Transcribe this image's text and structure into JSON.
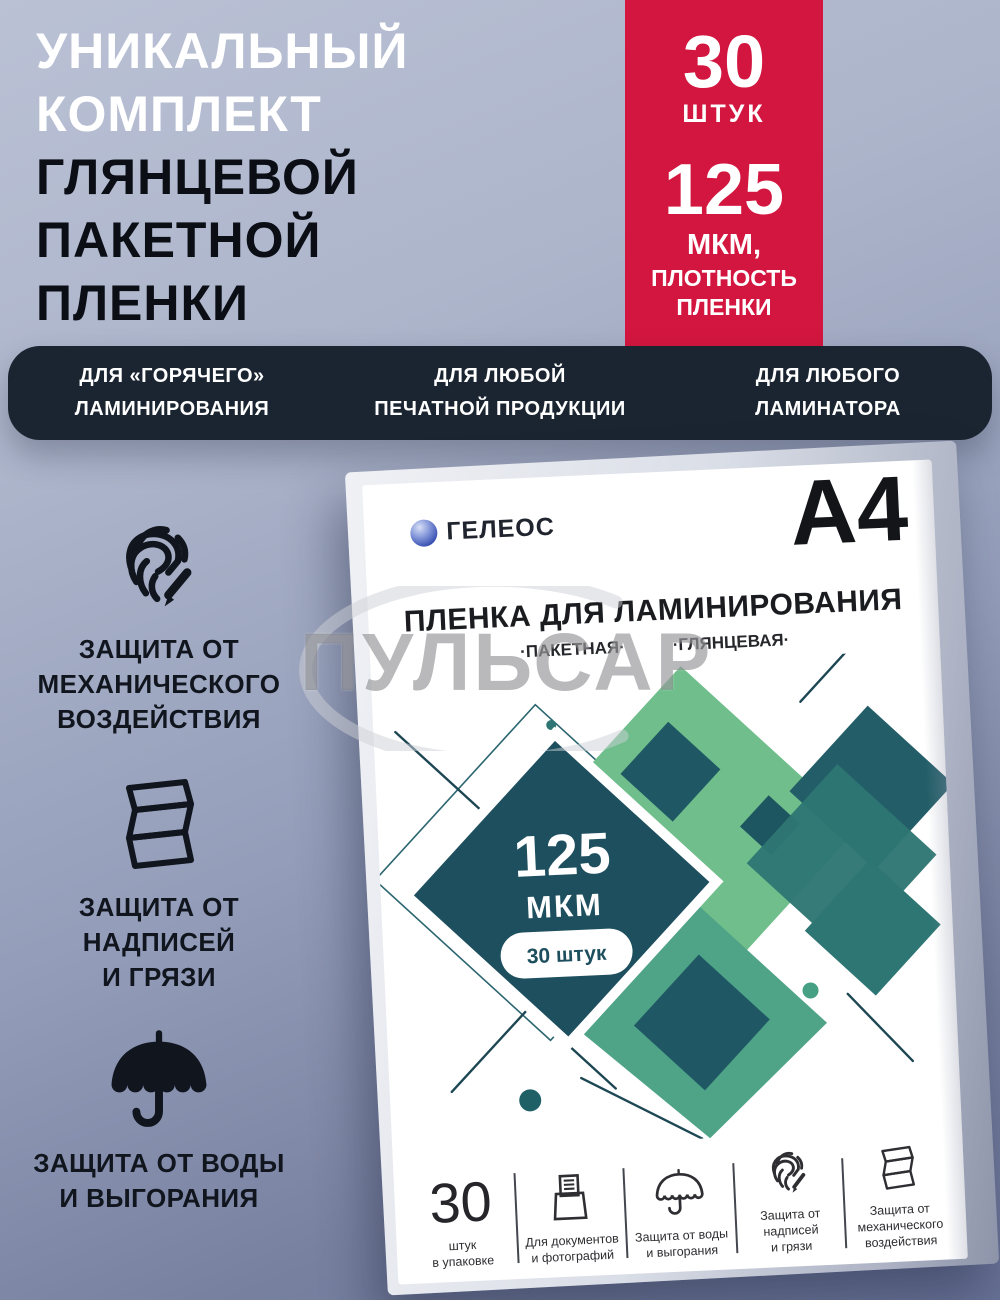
{
  "headline": {
    "lines": [
      "УНИКАЛЬНЫЙ",
      "КОМПЛЕКТ",
      "ГЛЯНЦЕВОЙ",
      "ПАКЕТНОЙ",
      "ПЛЕНКИ"
    ]
  },
  "badge": {
    "count": "30",
    "count_unit": "ШТУК",
    "micron_value": "125",
    "micron_unit": "МКМ,",
    "micron_label": "ПЛОТНОСТЬ\nПЛЕНКИ",
    "accent_color": "#d3163f"
  },
  "usp_bar": {
    "bg_color": "#1b2531",
    "items": [
      "ДЛЯ «ГОРЯЧЕГО»\nЛАМИНИРОВАНИЯ",
      "ДЛЯ ЛЮБОЙ\nПЕЧАТНОЙ ПРОДУКЦИИ",
      "ДЛЯ ЛЮБОГО\nЛАМИНАТОРА"
    ]
  },
  "features": [
    {
      "icon": "fingerprint-pencil-icon",
      "label": "ЗАЩИТА ОТ\nМЕХАНИЧЕСКОГО\nВОЗДЕЙСТВИЯ"
    },
    {
      "icon": "folded-film-icon",
      "label": "ЗАЩИТА ОТ\nНАДПИСЕЙ\nИ ГРЯЗИ"
    },
    {
      "icon": "umbrella-icon",
      "label": "ЗАЩИТА ОТ ВОДЫ\nИ ВЫГОРАНИЯ"
    }
  ],
  "package": {
    "brand": "ГЕЛЕОС",
    "format": "A4",
    "title": "ПЛЕНКА ДЛЯ ЛАМИНИРОВАНИЯ",
    "subtitle_left": "·ПАКЕТНАЯ·",
    "subtitle_right": "·ГЛЯНЦЕВАЯ·",
    "art": {
      "micron_value": "125",
      "micron_unit": "МКМ",
      "count_pill": "30 штук",
      "palette": {
        "navy": "#1d4f5e",
        "dark_teal": "#235d68",
        "teal": "#2e7673",
        "green_light": "#6fbe8c",
        "green": "#4fa487"
      }
    },
    "footer": [
      {
        "big": "30",
        "label": "штук\nв упаковке"
      },
      {
        "icon": "printer-icon",
        "label": "Для документов\nи фотографий"
      },
      {
        "icon": "umbrella-icon",
        "label": "Защита от воды\nи выгорания"
      },
      {
        "icon": "fingerprint-icon",
        "label": "Защита от\nнадписей\nи грязи"
      },
      {
        "icon": "folded-film-icon",
        "label": "Защита от\nмеханического\nвоздействия"
      }
    ]
  },
  "watermark": {
    "text": "ПУЛЬСАР"
  }
}
